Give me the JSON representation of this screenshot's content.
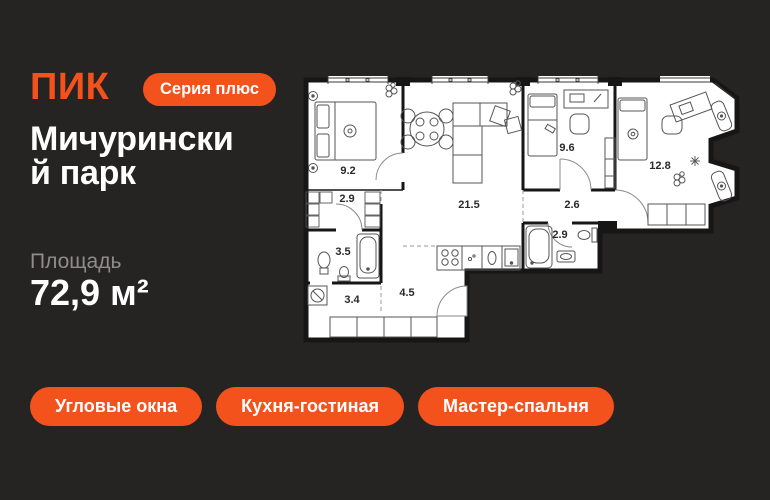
{
  "colors": {
    "background": "#262323",
    "accent": "#F4521D",
    "text_primary": "#FFFFFF",
    "text_secondary": "#8F8D8B",
    "plan_background": "#FFFFFF",
    "plan_walls": "#161616"
  },
  "header": {
    "logo": "ПИК",
    "series_badge": "Серия плюс"
  },
  "title": "Мичуринский парк",
  "area": {
    "label": "Площадь",
    "value": "72,9 м²"
  },
  "tags": [
    {
      "label": "Угловые окна"
    },
    {
      "label": "Кухня-гостиная"
    },
    {
      "label": "Мастер-спальня"
    }
  ],
  "floorplan": {
    "total_area": "72,9 м²",
    "rooms": [
      {
        "name": "bedroom",
        "area": "9.2"
      },
      {
        "name": "wardrobe",
        "area": "2.9"
      },
      {
        "name": "bathroom",
        "area": "3.5"
      },
      {
        "name": "hallway",
        "area": "3.4"
      },
      {
        "name": "entry-hall",
        "area": "4.5"
      },
      {
        "name": "kitchen-living-room",
        "area": "21.5"
      },
      {
        "name": "corridor",
        "area": "2.6"
      },
      {
        "name": "shower-room",
        "area": "2.9"
      },
      {
        "name": "bedroom-2",
        "area": "9.6"
      },
      {
        "name": "master-bedroom",
        "area": "12.8"
      }
    ]
  },
  "icons": {
    "plant-icon": "circle-cluster",
    "radiator-icon": "circled-dot",
    "snowflake-icon": "asterisk-lines",
    "washing-machine-icon": "square-with-drum",
    "door-arc-icon": "quarter-arc"
  }
}
